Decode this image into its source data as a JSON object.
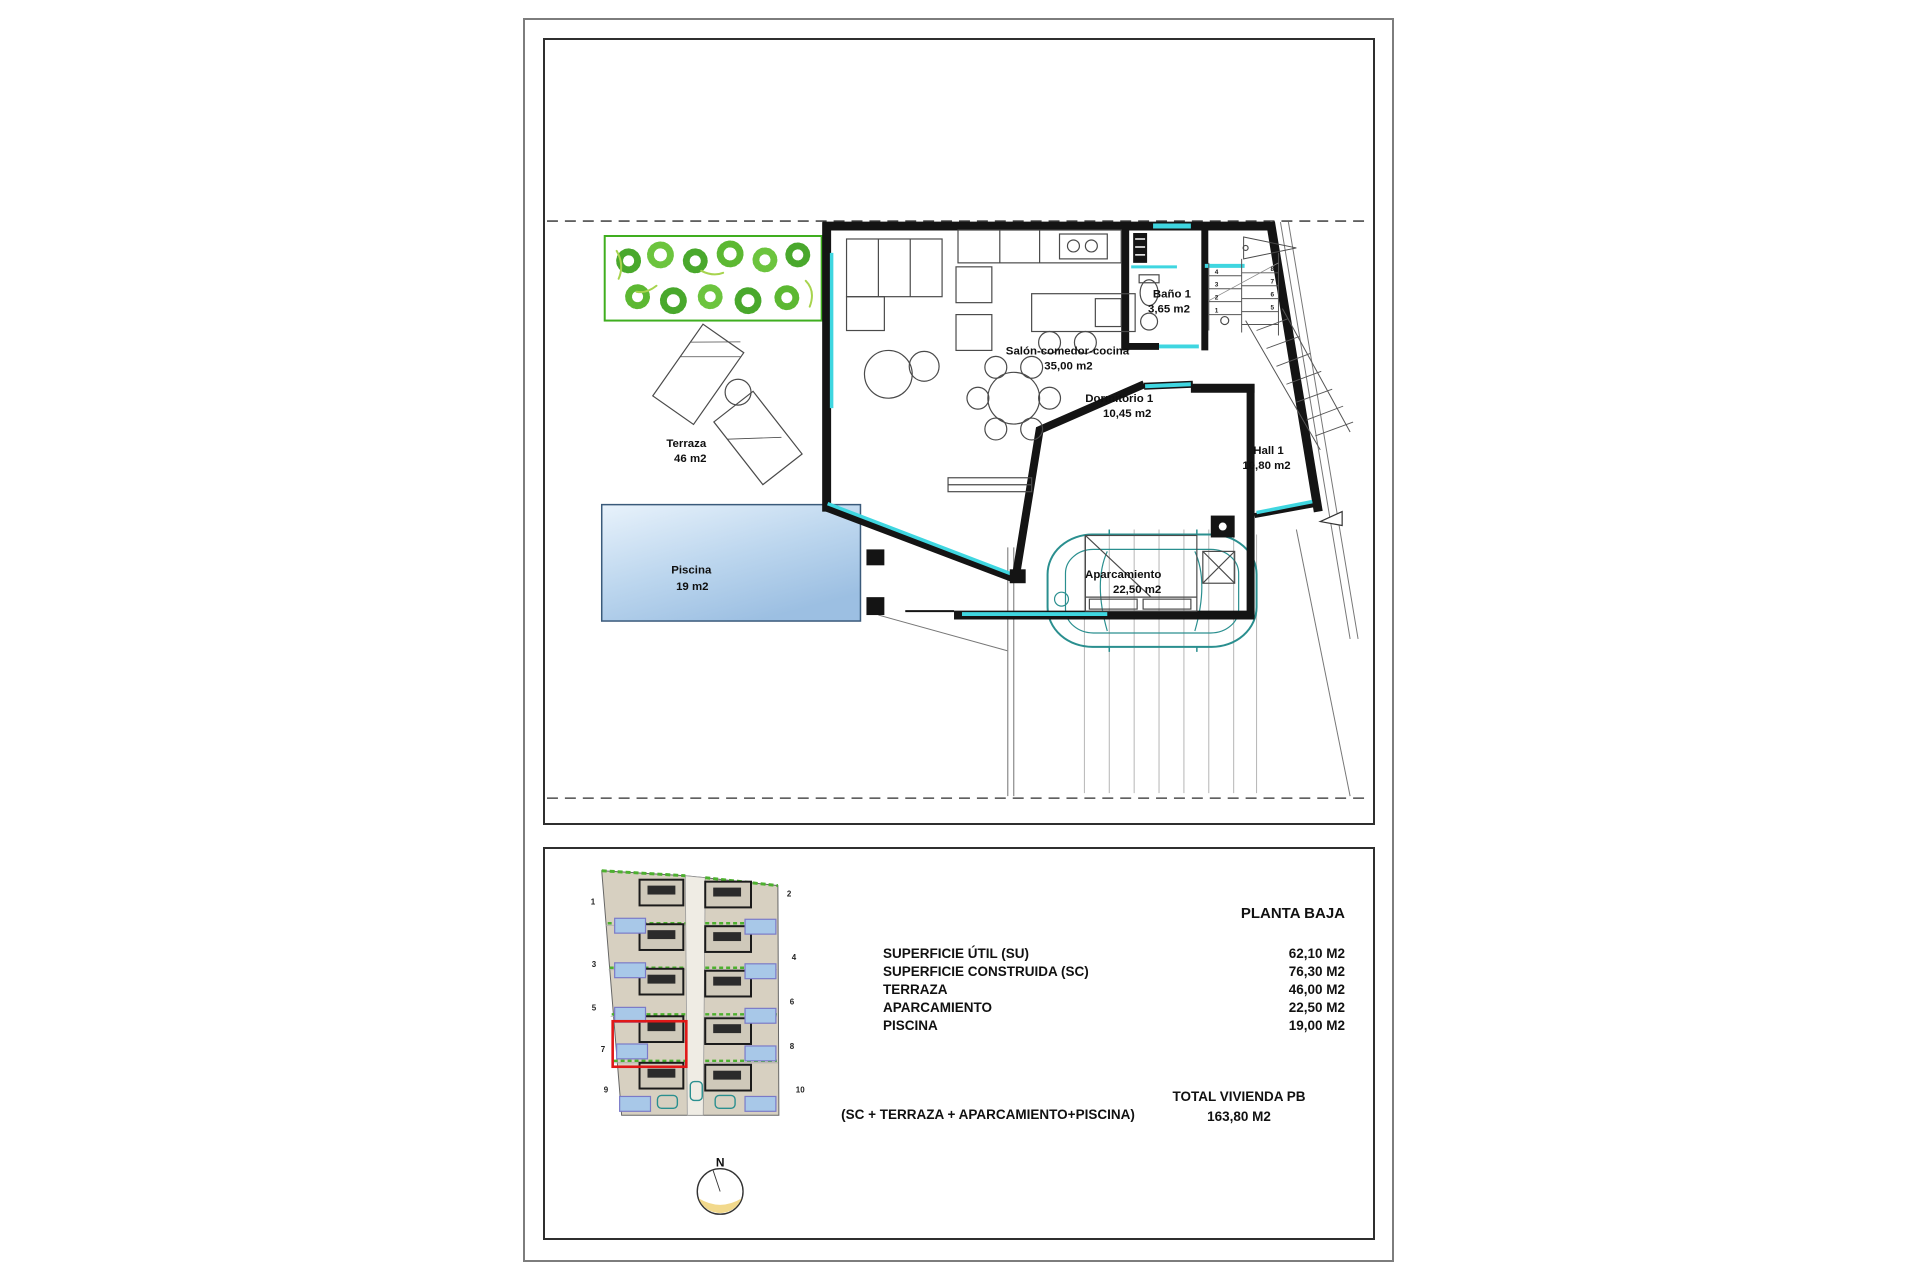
{
  "title": "VIVIENDA 7",
  "plan": {
    "terraza": {
      "name": "Terraza",
      "area": "46 m2"
    },
    "piscina": {
      "name": "Piscina",
      "area": "19 m2"
    },
    "salon": {
      "name": "Salón-comedor-cocina",
      "area": "35,00 m2"
    },
    "bano": {
      "name": "Baño 1",
      "area": "3,65 m2"
    },
    "dormitorio": {
      "name": "Dormitorio 1",
      "area": "10,45 m2"
    },
    "hall": {
      "name": "Hall 1",
      "area": "10,80 m2"
    },
    "aparcamiento": {
      "name": "Aparcamiento",
      "area": "22,50 m2"
    },
    "stairs": {
      "left": [
        "4",
        "3",
        "2",
        "1"
      ],
      "right": [
        "8",
        "7",
        "6",
        "5"
      ]
    }
  },
  "summary": {
    "heading": "PLANTA BAJA",
    "rows": [
      {
        "label": "SUPERFICIE ÚTIL (SU)",
        "value": "62,10 M2"
      },
      {
        "label": "SUPERFICIE CONSTRUIDA (SC)",
        "value": "76,30 M2"
      },
      {
        "label": "TERRAZA",
        "value": "46,00 M2"
      },
      {
        "label": "APARCAMIENTO",
        "value": "22,50 M2"
      },
      {
        "label": "PISCINA",
        "value": "19,00 M2"
      }
    ],
    "formula": "(SC + TERRAZA + APARCAMIENTO+PISCINA)",
    "total_label": "TOTAL VIVIENDA PB",
    "total_value": "163,80 M2"
  },
  "siteplan": {
    "unit_numbers": [
      "1",
      "2",
      "3",
      "4",
      "5",
      "6",
      "7",
      "8",
      "9",
      "10"
    ],
    "north": "N",
    "highlighted_unit": "7"
  },
  "colors": {
    "glass_cyan": "#3fd6e0",
    "plant_green": "#4db02f",
    "highlight_red": "#e01818",
    "car_teal": "#2a8f8f",
    "pool_light": "#e8f2fb",
    "pool_dark": "#9cbfe2",
    "site_beige": "#d7d0c1",
    "border_gray": "#7d7d7d"
  }
}
